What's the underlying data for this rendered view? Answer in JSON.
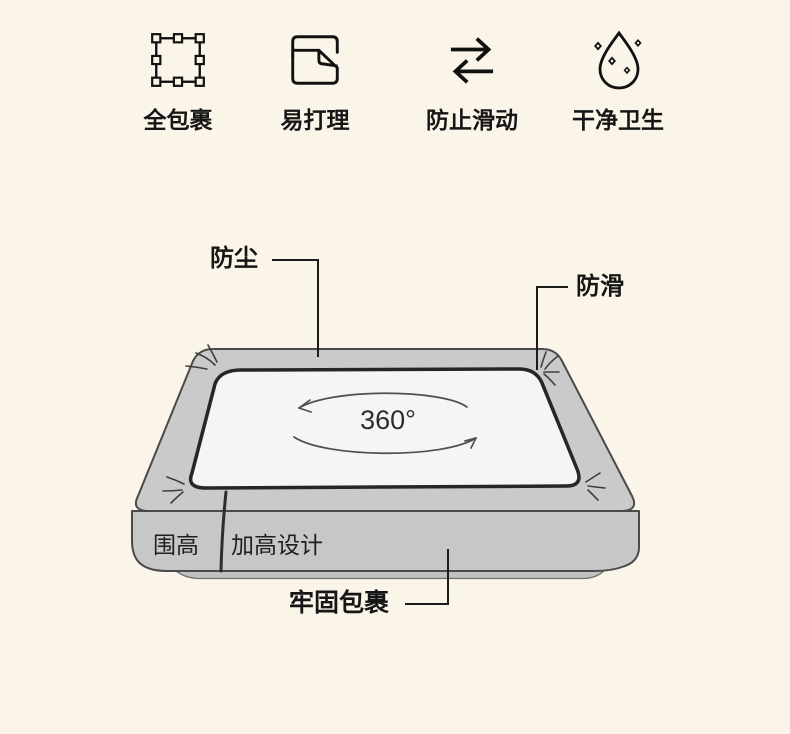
{
  "page": {
    "background_color": "#fbf4e8",
    "text_color": "#161616"
  },
  "features": [
    {
      "label": "全包裹",
      "icon": "selection-frame-icon"
    },
    {
      "label": "易打理",
      "icon": "folded-sheet-icon"
    },
    {
      "label": "防止滑动",
      "icon": "swap-arrows-icon"
    },
    {
      "label": "干净卫生",
      "icon": "clean-drop-icon"
    }
  ],
  "diagram": {
    "rotation_label": "360°",
    "callouts": {
      "dustproof": "防尘",
      "antislip": "防滑",
      "secure_wrap": "牢固包裹"
    },
    "side_labels": {
      "height_ring": "围高",
      "raised_design": "加高设计"
    },
    "colors": {
      "mattress_gray": "#c8c8c8",
      "sheet_white": "#f5f5f3",
      "outline_dark": "#2d2d2d"
    }
  }
}
